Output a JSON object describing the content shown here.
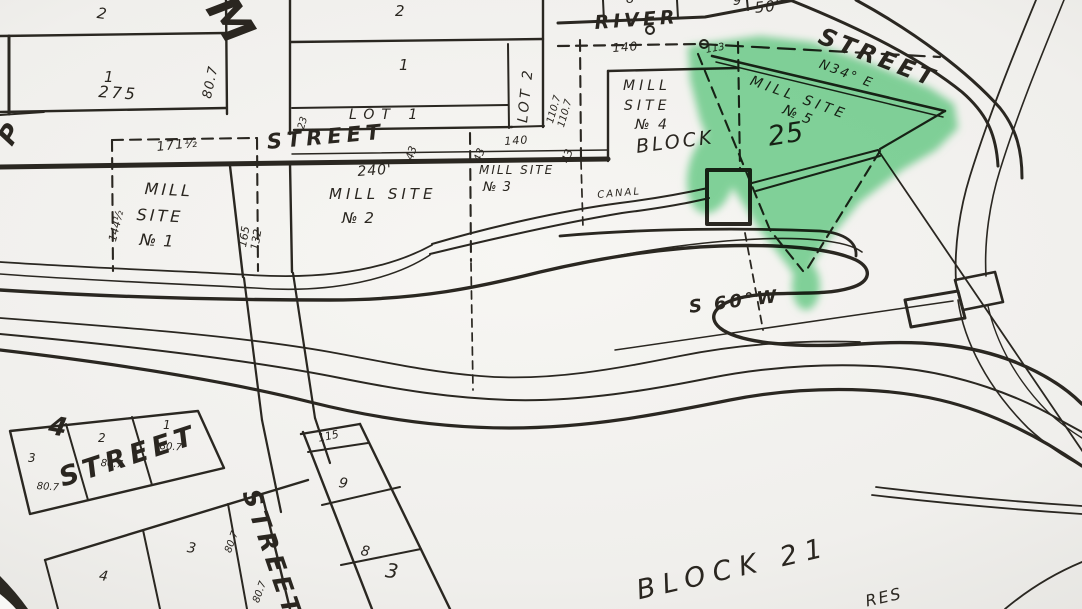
{
  "colors": {
    "paper": "#f2f1ee",
    "ink": "#2a2721",
    "highlight": "#86dba2"
  },
  "streets": {
    "west": "STREET",
    "river": "RIVER",
    "northeast": "STREET",
    "southwest": "STREET",
    "south_vertical": "STREET",
    "partial_top": "M",
    "partial_left": "P"
  },
  "parcels": {
    "ms1_l1": "MILL",
    "ms1_l2": "SITE",
    "ms1_l3": "№ 1",
    "ms2_l1": "MILL SITE",
    "ms2_l2": "№ 2",
    "ms3_l1": "MILL SITE",
    "ms3_l2": "№ 3",
    "ms4_l1": "MILL",
    "ms4_l2": "SITE",
    "ms4_l3": "№ 4",
    "ms5_l1": "MILL SITE",
    "ms5_l2": "№ 5",
    "block25_word": "BLOCK",
    "block25_num": "25",
    "block21": "BLOCK 21",
    "block4_num": "4",
    "lot1": "LOT 1",
    "lot2": "LOT 2",
    "canal": "CANAL",
    "acres_partial": "RES"
  },
  "bearings": {
    "n34e": "N34° E",
    "s60w": "S 60°W"
  },
  "dims": {
    "d275": "275",
    "d807": "80.7",
    "d171half": "171½",
    "d23": "23",
    "d43": "43",
    "d140": "140",
    "d110_7": "110.7",
    "d50": "50'",
    "d113": "113",
    "d115": "115",
    "d144half": "144½",
    "d165": "165",
    "d132": "132",
    "d240": "240'"
  },
  "lots": {
    "blockA_2": "2",
    "blockA_1": "1",
    "blockB_2": "2",
    "blockB_1": "1",
    "top_8": "8",
    "top_9": "9",
    "block4_3": "3",
    "block4_2": "2",
    "block4_1": "1",
    "lower_4": "4",
    "lower_3": "3",
    "col_9": "9",
    "col_8": "8",
    "col_3": "3"
  }
}
